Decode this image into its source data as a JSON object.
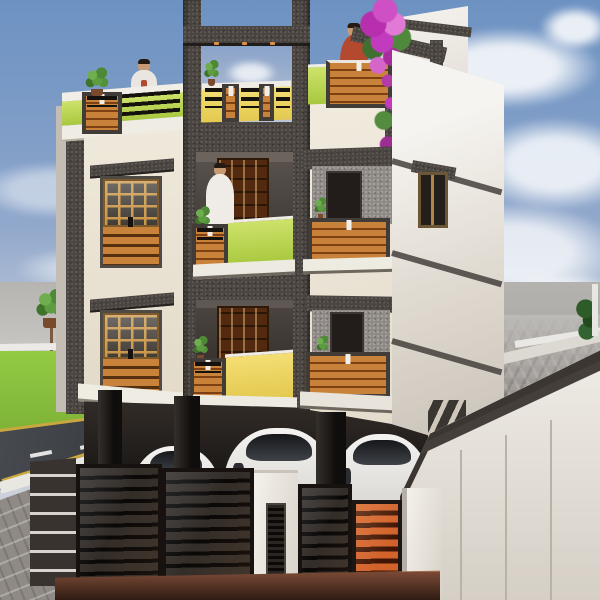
{
  "scene": {
    "label": "3D exterior render of a three-storey residential apartment building with stilt parking, black compound gate, lawn and road",
    "sky": {
      "top": "#6d92c2",
      "horizon": "#cfd3da",
      "clouds": "#ffffff"
    },
    "landscape": {
      "label": "lawn, asphalt road with markings, brick sidewalk and woven paver yard",
      "grass": "#8dc63f",
      "road": "#3d4046",
      "road_markings": [
        "yellow-edge-lines",
        "white-center-dashes",
        "white-curb"
      ],
      "marking_yellow": "#c9a83d",
      "sidewalk_bricks": "#8f8a85",
      "pavers_woven": "#9d9792",
      "apron_brown": "#6e4433",
      "trees": 3
    },
    "building": {
      "label": "three-storey building, cream walls with charcoal feature tower, lime and yellow balcony parapets, wooden louver panels",
      "floors": 3,
      "palette": {
        "wall_cream": "#efe9db",
        "accent_charcoal": "#4b4541",
        "parapet_lime": "#bcd94e",
        "parapet_yellow": "#f0d863",
        "wood_slats": "#c9823a",
        "railing_black": "#15110d",
        "side_wall_white": "#f2efe9",
        "door_wood": "#53290f"
      },
      "elements": [
        "terrace-pergola-frame",
        "terrace-railing",
        "recessed-balconies",
        "wood-louver-windows",
        "stilt-parking",
        "side-staircase",
        "downlights"
      ]
    },
    "people": [
      {
        "id": "person-terrace-left",
        "shirt": "#e9e5e0"
      },
      {
        "id": "person-balcony-middle",
        "shirt": "#efece8"
      },
      {
        "id": "person-terrace-right",
        "shirt": "#b5492f"
      }
    ],
    "vehicles": {
      "label": "three white cars parked in stilt parking",
      "count": 3,
      "color": "#ebeae8"
    },
    "plants": {
      "potted_shrubs": 7,
      "flowering_vine_color": "#c23bbf"
    },
    "compound": {
      "label": "black louver gates with white pillars, orange louver panel and white boundary wall",
      "fence_black": "#262120",
      "gate_orange": "#c85c2a",
      "pillar_white": "#efece6",
      "wall_white": "#efece6",
      "trim_charcoal": "#3b3632",
      "brick_pillar": "#38332f"
    }
  }
}
